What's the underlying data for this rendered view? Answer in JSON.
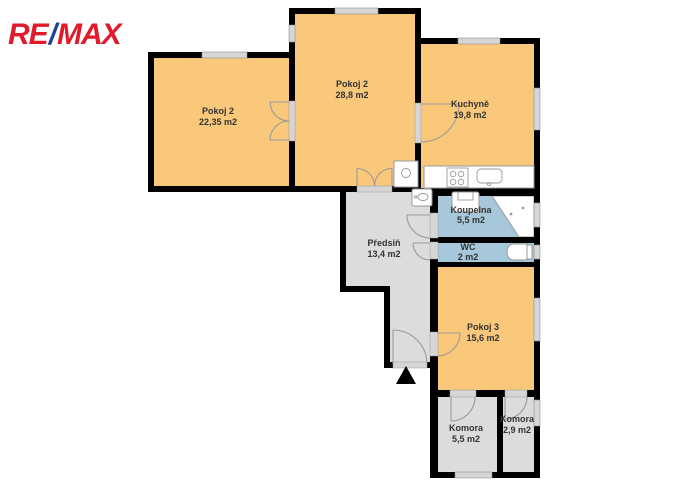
{
  "logo": {
    "re": "RE",
    "slash": "/",
    "max": "MAX"
  },
  "colors": {
    "bg": "#ffffff",
    "room_fill": "#f9c87b",
    "wet_fill": "#a6c8da",
    "hall_fill": "#dcdcdc",
    "wall": "#000000",
    "window_fill": "#d6d6d6",
    "fixture_stroke": "#9a9a9a",
    "label": "#333333",
    "logo_red": "#e01b2c",
    "logo_blue": "#1f4396"
  },
  "rooms": [
    {
      "id": "pokoj2-left",
      "name": "Pokoj 2",
      "area": "22,35 m2"
    },
    {
      "id": "pokoj2-mid",
      "name": "Pokoj 2",
      "area": "28,8 m2"
    },
    {
      "id": "kuchyne",
      "name": "Kuchyně",
      "area": "19,8 m2"
    },
    {
      "id": "koupelna",
      "name": "Koupelna",
      "area": "5,5 m2"
    },
    {
      "id": "wc",
      "name": "WC",
      "area": "2 m2"
    },
    {
      "id": "predsin",
      "name": "Předsiň",
      "area": "13,4 m2"
    },
    {
      "id": "pokoj3",
      "name": "Pokoj 3",
      "area": "15,6 m2"
    },
    {
      "id": "komora-velka",
      "name": "Komora",
      "area": "5,5 m2"
    },
    {
      "id": "komora-mala",
      "name": "Komora",
      "area": "2,9 m2"
    }
  ]
}
